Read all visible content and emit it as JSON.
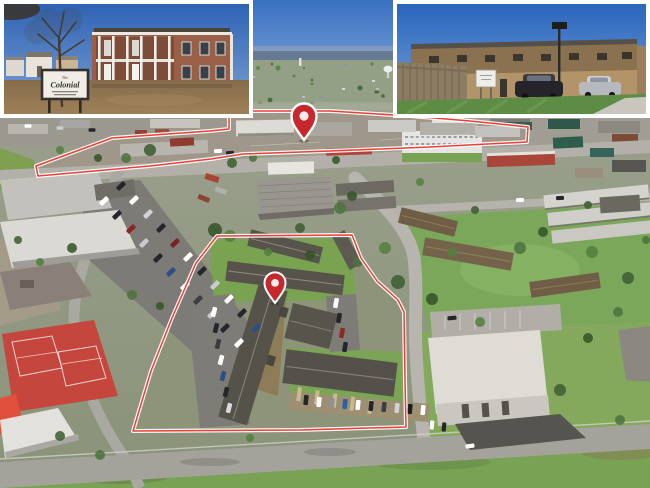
{
  "colors": {
    "outline_red": "#e8413a",
    "pin_red": "#c6282c",
    "tennis_court_red": "#c5463c"
  },
  "insets": {
    "left": {
      "sign": {
        "top_word": "The",
        "name": "Colonial"
      }
    }
  }
}
